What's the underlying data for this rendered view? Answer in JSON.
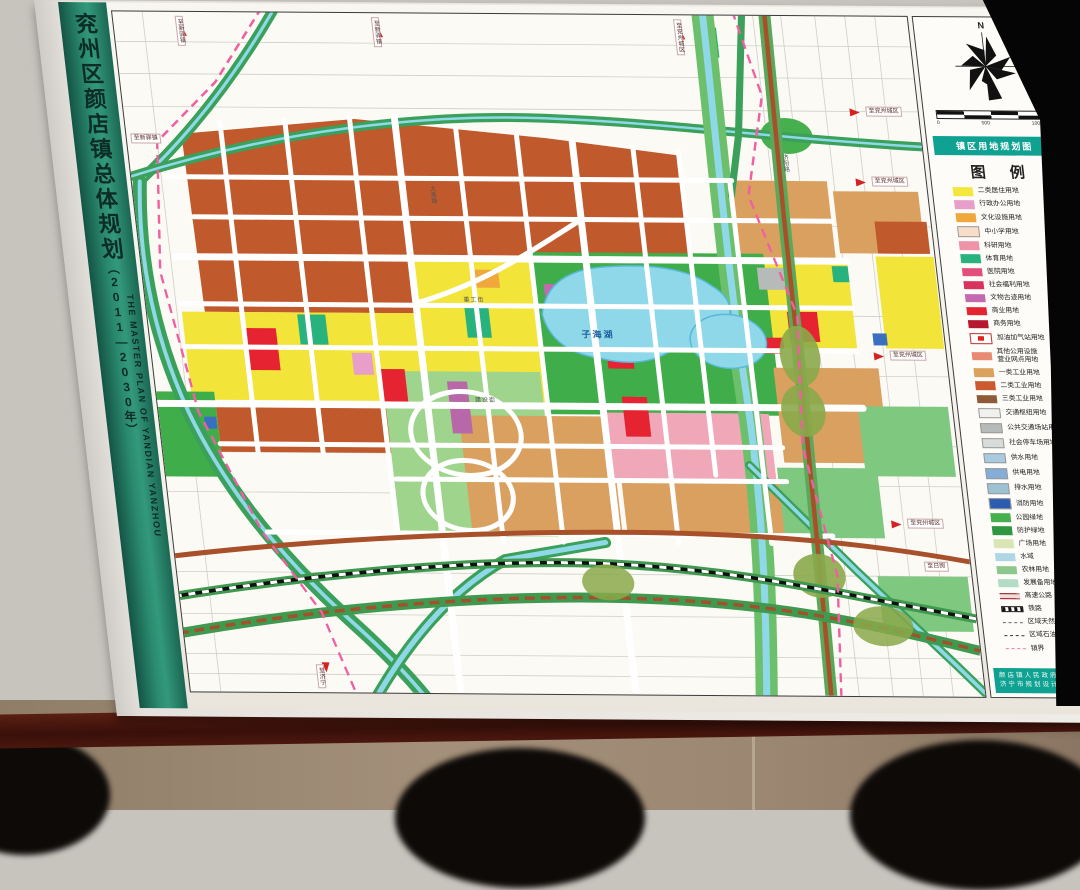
{
  "spine": {
    "title_cn": "兖州区颜店镇总体规划",
    "years": "（2011—2030年）",
    "title_en": "THE MASTER PLAN OF YANDIAN YANZHOU"
  },
  "sheet": {
    "banner": "镇区用地规划图",
    "legend_title": "图  例",
    "north_label": "N",
    "scale_ticks": [
      "0",
      "500",
      "1000m"
    ],
    "credit_line1": "颜店镇人民政府",
    "credit_line2": "济宁市规划设计研究院",
    "page_number": "45",
    "accent_teal": "#0fa191",
    "spine_green": "#2a8a6e"
  },
  "legend": {
    "items": [
      {
        "label": "二类居住用地",
        "symbol": "swatch",
        "color": "#f5e63c"
      },
      {
        "label": "行政办公用地",
        "symbol": "swatch",
        "color": "#e79ec9"
      },
      {
        "label": "文化设施用地",
        "symbol": "swatch",
        "color": "#f0a83c"
      },
      {
        "label": "中小学用地",
        "symbol": "swatch-border",
        "color": "#f8ddc8"
      },
      {
        "label": "科研用地",
        "symbol": "swatch",
        "color": "#ef93a8"
      },
      {
        "label": "体育用地",
        "symbol": "swatch",
        "color": "#27b27e"
      },
      {
        "label": "医院用地",
        "symbol": "swatch",
        "color": "#e24e7e"
      },
      {
        "label": "社会福利用地",
        "symbol": "swatch",
        "color": "#d8325f"
      },
      {
        "label": "文物古迹用地",
        "symbol": "swatch",
        "color": "#c468b0"
      },
      {
        "label": "商业用地",
        "symbol": "swatch",
        "color": "#e62330"
      },
      {
        "label": "商务用地",
        "symbol": "swatch",
        "color": "#b5182f"
      },
      {
        "label": "加油加气站用地",
        "symbol": "swatch-gas",
        "color": "#ffffff"
      },
      {
        "label": "其他公用设施\n营业网点用地",
        "symbol": "swatch",
        "color": "#e98a74"
      },
      {
        "label": "一类工业用地",
        "symbol": "swatch",
        "color": "#dba25e"
      },
      {
        "label": "二类工业用地",
        "symbol": "swatch",
        "color": "#cb5a30"
      },
      {
        "label": "三类工业用地",
        "symbol": "swatch",
        "color": "#8e5a38"
      },
      {
        "label": "交通枢纽用地",
        "symbol": "swatch-border",
        "color": "#f0f0ee"
      },
      {
        "label": "公共交通场站用地",
        "symbol": "swatch-border",
        "color": "#b6bab8"
      },
      {
        "label": "社会停车场用地",
        "symbol": "swatch-border",
        "color": "#d8dcda"
      },
      {
        "label": "供水用地",
        "symbol": "swatch-border",
        "color": "#aacade"
      },
      {
        "label": "供电用地",
        "symbol": "swatch-border",
        "color": "#84aed6"
      },
      {
        "label": "排水用地",
        "symbol": "swatch-border",
        "color": "#9cc2d4"
      },
      {
        "label": "消防用地",
        "symbol": "swatch-border",
        "color": "#2b5cb0"
      },
      {
        "label": "公园绿地",
        "symbol": "swatch",
        "color": "#46b04e"
      },
      {
        "label": "防护绿地",
        "symbol": "swatch",
        "color": "#2f9740"
      },
      {
        "label": "广场用地",
        "symbol": "swatch",
        "color": "#d9e6b4"
      },
      {
        "label": "水域",
        "symbol": "swatch",
        "color": "#aed6e4"
      },
      {
        "label": "农林用地",
        "symbol": "swatch",
        "color": "#8cc88e"
      },
      {
        "label": "发展备用地",
        "symbol": "swatch",
        "color": "#b2dcc6"
      },
      {
        "label": "高速公路",
        "symbol": "line-expressway"
      },
      {
        "label": "铁路",
        "symbol": "line-railway"
      },
      {
        "label": "区域天然气管道",
        "symbol": "line-gasline"
      },
      {
        "label": "区域石油管道",
        "symbol": "line-oilline"
      },
      {
        "label": "镇界",
        "symbol": "line-boundary"
      }
    ]
  },
  "map": {
    "labels": [
      {
        "text": "子海湖",
        "x": 432,
        "y": 316,
        "kind": "lake",
        "name": "lake-label"
      },
      {
        "text": "至新驿镇",
        "x": 62,
        "y": 4,
        "kind": "box-v",
        "name": "edge-label"
      },
      {
        "text": "至新驿镇",
        "x": 258,
        "y": 4,
        "kind": "box-v",
        "name": "edge-label"
      },
      {
        "text": "至兖州城区",
        "x": 560,
        "y": 4,
        "kind": "box-v",
        "name": "edge-label"
      },
      {
        "text": "至新驿镇",
        "x": 4,
        "y": 122,
        "kind": "box-h",
        "name": "edge-label"
      },
      {
        "text": "至兖州城区",
        "x": 742,
        "y": 90,
        "kind": "box-h",
        "name": "edge-label"
      },
      {
        "text": "至兖州城区",
        "x": 740,
        "y": 160,
        "kind": "box-h",
        "name": "edge-label"
      },
      {
        "text": "至兖州城区",
        "x": 738,
        "y": 334,
        "kind": "box-h",
        "name": "edge-label"
      },
      {
        "text": "至兖州城区",
        "x": 736,
        "y": 502,
        "kind": "box-h",
        "name": "edge-label"
      },
      {
        "text": "至日照",
        "x": 748,
        "y": 545,
        "kind": "box-h",
        "name": "edge-label"
      },
      {
        "text": "至济宁",
        "x": 128,
        "y": 652,
        "kind": "box-v",
        "name": "edge-label"
      },
      {
        "text": "大禹路",
        "x": 296,
        "y": 172,
        "kind": "road-v",
        "name": "road-label"
      },
      {
        "text": "济阳路",
        "x": 652,
        "y": 138,
        "kind": "road-v",
        "name": "road-label"
      },
      {
        "text": "重工街",
        "x": 318,
        "y": 284,
        "kind": "road-h",
        "name": "road-label"
      },
      {
        "text": "建设街",
        "x": 318,
        "y": 384,
        "kind": "road-h",
        "name": "road-label"
      }
    ]
  }
}
